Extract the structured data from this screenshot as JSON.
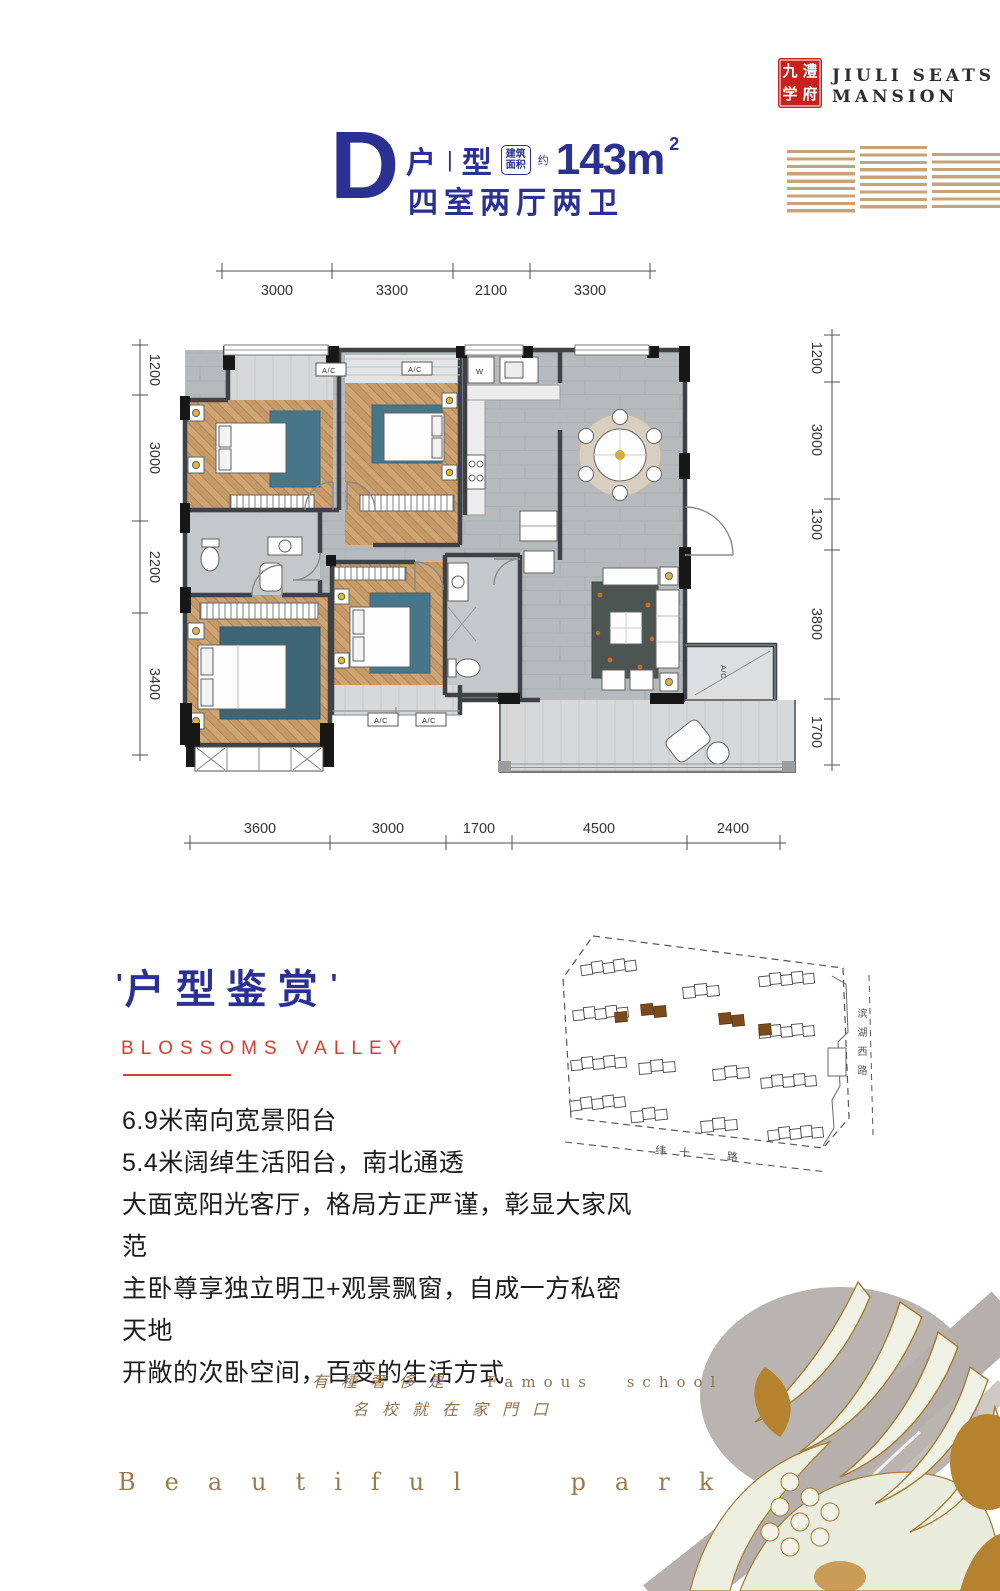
{
  "brand": {
    "seal": [
      "九",
      "澧",
      "学",
      "府"
    ],
    "name_line1": "JIULI SEATS",
    "name_line2": "MANSION"
  },
  "unit": {
    "letter": "D",
    "type_left": "户",
    "type_divider": "|",
    "type_right": "型",
    "area_box_top": "建筑",
    "area_box_bottom": "面积",
    "approx": "约",
    "area_value": "143m",
    "area_sup": "2",
    "layout": "四室两厅两卫"
  },
  "floorplan": {
    "ac_label": "A/C",
    "washer_label": "W",
    "dims_top": [
      "3000",
      "3300",
      "2100",
      "3300"
    ],
    "dims_bottom": [
      "3600",
      "3000",
      "1700",
      "4500",
      "2400"
    ],
    "dims_left": [
      "1200",
      "3000",
      "2200",
      "3400"
    ],
    "dims_right": [
      "1200",
      "3000",
      "1300",
      "3800",
      "1700"
    ]
  },
  "siteplan": {
    "road_bottom": "纬十一路",
    "road_right": "滨湖西路"
  },
  "showcase": {
    "quote_mark": "'",
    "title": "户型鉴赏",
    "subtitle": "BLOSSOMS VALLEY",
    "features": [
      "6.9米南向宽景阳台",
      "5.4米阔绰生活阳台，南北通透",
      "大面宽阳光客厅，格局方正严谨，彰显大家风范",
      "主卧尊享独立明卫+观景飘窗，自成一方私密天地",
      "开敞的次卧空间，百变的生活方式"
    ]
  },
  "footer": {
    "tagline_cn": "有種奢侈是",
    "tagline_en": "Famous school",
    "tagline_cn2": "名校就在家門口",
    "watermark": "Beautiful park"
  },
  "colors": {
    "navy": "#2b3192",
    "red": "#e03a2d",
    "seal_red": "#c4211f",
    "bronze": "#8f7352",
    "stripe_gold": "#c7a379"
  }
}
